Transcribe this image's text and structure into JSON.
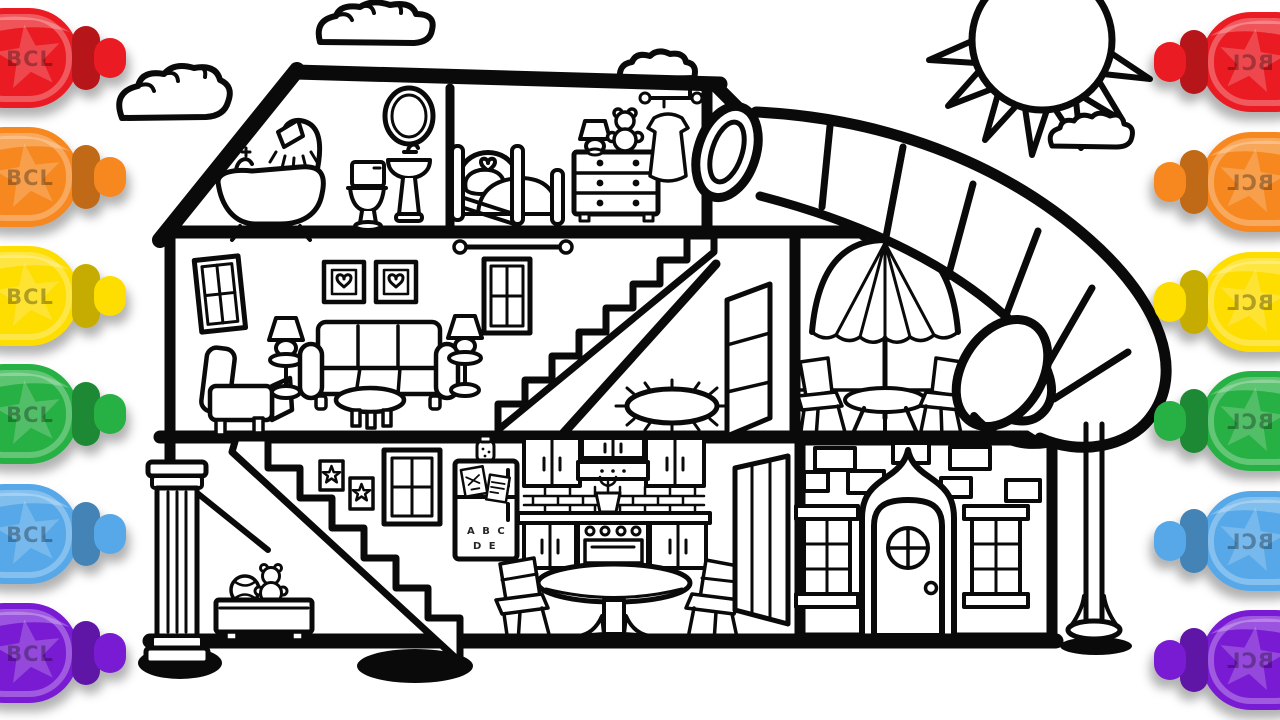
{
  "background": "#ffffff",
  "line_color": "#000000",
  "markers": {
    "label": "BCL",
    "items": [
      {
        "name": "red",
        "color": "#ea1b22"
      },
      {
        "name": "orange",
        "color": "#f6881f"
      },
      {
        "name": "yellow",
        "color": "#fedd00"
      },
      {
        "name": "green",
        "color": "#27b043"
      },
      {
        "name": "blue",
        "color": "#56a8e8"
      },
      {
        "name": "purple",
        "color": "#7a1bd4"
      }
    ],
    "left_order": [
      "red",
      "orange",
      "yellow",
      "green",
      "blue",
      "purple"
    ],
    "right_order": [
      "red",
      "orange",
      "yellow",
      "green",
      "blue",
      "purple"
    ],
    "right_mirrored": true
  },
  "scene": {
    "type": "coloring-page line art",
    "subject": "dollhouse cutaway with spiral tube slide, sun and clouds",
    "sky": [
      "sun",
      "cloud-top-center",
      "cloud-left",
      "cloud-by-sun",
      "cloud-behind-roof"
    ],
    "rooms": {
      "bathroom": [
        "shower",
        "clawfoot-bathtub",
        "toilet",
        "pedestal-sink",
        "oval-mirror"
      ],
      "bedroom": [
        "heart-headboard-bed",
        "table-lamp",
        "teddy-bear",
        "dresser",
        "clothes-rod-with-dress",
        "porthole-slide-entrance"
      ],
      "living_room": [
        "window",
        "armchair",
        "floor-lamp",
        "sofa",
        "coffee-table",
        "floor-lamp",
        "heart-picture",
        "heart-picture",
        "window",
        "curtain-rod"
      ],
      "hall": [
        "staircase-up",
        "closet-door",
        "oval-rug"
      ],
      "patio": [
        "parasol-umbrella",
        "patio-table",
        "patio-chair",
        "patio-chair"
      ],
      "playroom": [
        "staircase-down",
        "star-picture",
        "star-picture",
        "window",
        "toy-box",
        "ball",
        "teddy-bear",
        "porch-column"
      ],
      "kitchen": [
        "refrigerator",
        "cookie-jar",
        "wall-cabinets",
        "range-hood",
        "brick-backsplash",
        "plant",
        "stove-oven",
        "dining-table",
        "chair",
        "chair",
        "open-door"
      ],
      "facade": [
        "scattered-bricks",
        "arched-front-door",
        "round-door-window",
        "paned-window",
        "paned-window"
      ]
    },
    "outdoor": [
      "tube-slide",
      "slide-support-pole",
      "ground-shadow"
    ],
    "fridge_magnets_row1": "A B C",
    "fridge_magnets_row2": "D E"
  }
}
